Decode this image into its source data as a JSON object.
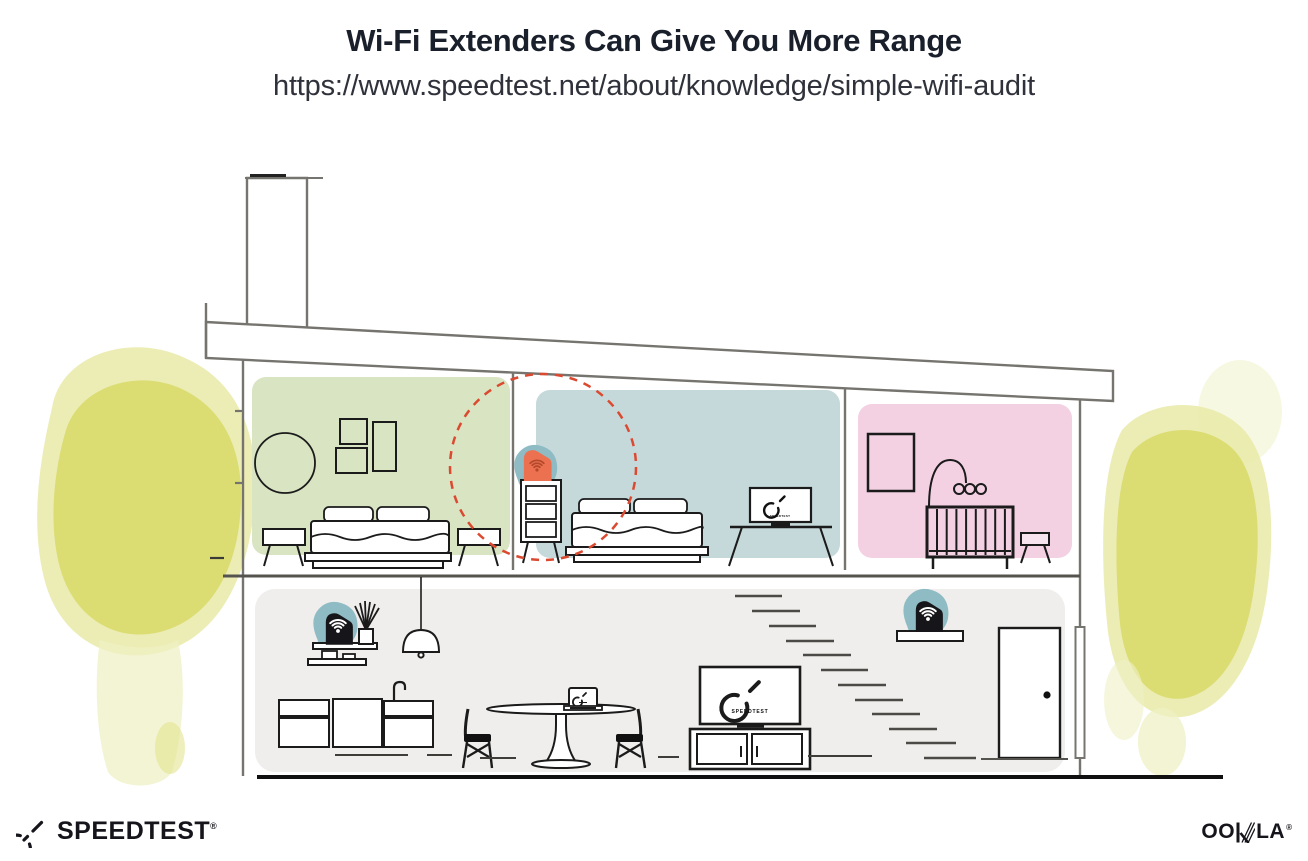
{
  "header": {
    "title": "Wi-Fi Extenders Can Give You More Range",
    "url": "https://www.speedtest.net/about/knowledge/simple-wifi-audit"
  },
  "footer": {
    "speedtest_wordmark": "SPEEDTEST",
    "speedtest_registered_mark": "®",
    "ookla_wordmark": "OOKLA",
    "ookla_wordmark_part1": "OO",
    "ookla_wordmark_part2": "LA",
    "ookla_registered_mark": "®"
  },
  "illustration": {
    "tv_screen_label": "SPEEDTEST",
    "range_circle_color": "#db4a30",
    "foliage_color": "#d8d967",
    "rooms": [
      {
        "name": "bedroom-left",
        "fill": "#d9e4c2"
      },
      {
        "name": "bedroom-middle",
        "fill": "#c6d9da"
      },
      {
        "name": "nursery",
        "fill": "#f3d1e3"
      },
      {
        "name": "living-area",
        "fill": "#f0eeec"
      }
    ],
    "devices": [
      {
        "name": "wifi-extender-upstairs",
        "body_color": "#ec7150",
        "wifi_color": "#b5492c",
        "glow_color": "#8fbcc4"
      },
      {
        "name": "wifi-router-shelf-left",
        "body_color": "#16161a",
        "wifi_color": "#ffffff",
        "glow_color": "#8fbcc4"
      },
      {
        "name": "wifi-extender-stairs",
        "body_color": "#16161a",
        "wifi_color": "#ffffff",
        "glow_color": "#8fbcc4"
      }
    ]
  }
}
